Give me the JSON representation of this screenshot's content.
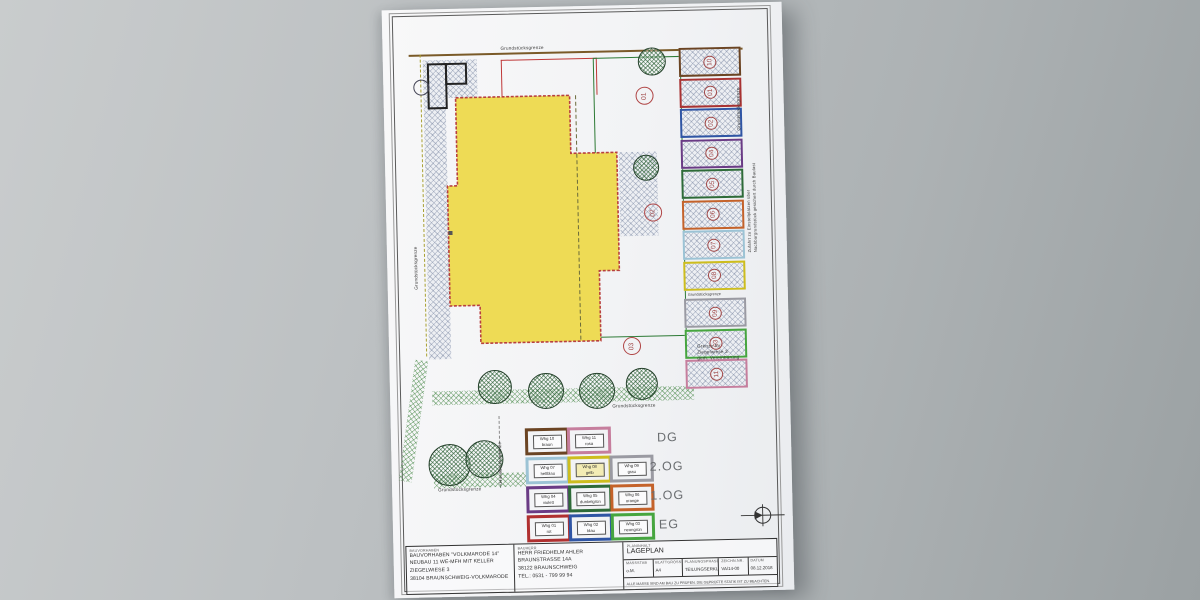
{
  "paper": {
    "labels": {
      "grundstuecksgrenze": "Grundstücksgrenze",
      "zufahrt_line1": "Zufahrt zu Einstellplätzen über",
      "zufahrt_line2": "Nachbargrundstück gesichert durch Baulast",
      "grenze_line1": "Grenze für",
      "grenze_line2": "Ziegelwiese 3",
      "grenze_line3": "gem. Vereinbarung"
    },
    "area_markers": {
      "m1": "01",
      "m2": "02",
      "m3": "03"
    },
    "parking_stalls": [
      {
        "number": "10",
        "color": "#6b4423"
      },
      {
        "number": "01",
        "color": "#a83232"
      },
      {
        "number": "02",
        "color": "#2f55a4"
      },
      {
        "number": "04",
        "color": "#6a3b85"
      },
      {
        "number": "05",
        "color": "#2e6b38"
      },
      {
        "number": "06",
        "color": "#c4622a"
      },
      {
        "number": "07",
        "color": "#9cc3d5"
      },
      {
        "number": "08",
        "color": "#cdbd1e"
      },
      {
        "number": "09",
        "color": "#9a9aa2"
      },
      {
        "number": "03",
        "color": "#46a53f"
      },
      {
        "number": "11",
        "color": "#c67e9d"
      }
    ],
    "legend": {
      "rows": [
        {
          "floor": "DG",
          "items": [
            {
              "label": "Whg 10",
              "color_name": "braun",
              "color": "#6b4423"
            },
            {
              "label": "Whg 11",
              "color_name": "rosa",
              "color": "#c67e9d"
            }
          ]
        },
        {
          "floor": "2.OG",
          "items": [
            {
              "label": "Whg 07",
              "color_name": "hellblau",
              "color": "#9cc3d5"
            },
            {
              "label": "Whg 08",
              "color_name": "gelb",
              "color": "#cdbd1e"
            },
            {
              "label": "Whg 09",
              "color_name": "grau",
              "color": "#9a9aa2"
            }
          ]
        },
        {
          "floor": "1.OG",
          "items": [
            {
              "label": "Whg 04",
              "color_name": "violett",
              "color": "#6a3b85"
            },
            {
              "label": "Whg 05",
              "color_name": "dunkelgrün",
              "color": "#2e6b38"
            },
            {
              "label": "Whg 06",
              "color_name": "orange",
              "color": "#c4622a"
            }
          ]
        },
        {
          "floor": "EG",
          "items": [
            {
              "label": "Whg 01",
              "color_name": "rot",
              "color": "#b03030"
            },
            {
              "label": "Whg 02",
              "color_name": "blau",
              "color": "#2f55a4"
            },
            {
              "label": "Whg 03",
              "color_name": "neongrün",
              "color": "#46a53f"
            }
          ]
        }
      ]
    },
    "titleblock": {
      "col1_header": "BAUVORHABEN",
      "col1_lines": [
        "BAUVORHABEN \"VOLKMARODE 14\"",
        "NEUBAU 11 WE-MFH MIT KELLER",
        "ZIEGELWIESE 3",
        "38104 BRAUNSCHWEIG-VOLKMARODE"
      ],
      "col2_header": "BAUHERR",
      "col2_lines": [
        "HERR FRIEDHELM AHLER",
        "BRAUNSTRASSE 14A",
        "38122 BRAUNSCHWEIG",
        "TEL.: 0531  -  799 99 94"
      ],
      "col3_header": "PLANINHALT",
      "plan_title": "LAGEPLAN",
      "fields": [
        {
          "header": "MASSSTAB",
          "value": "o.M."
        },
        {
          "header": "BLATTGRÖSSE",
          "value": "A4"
        },
        {
          "header": "PLANUNGSPHASE",
          "value": "TEILUNGSERKL."
        },
        {
          "header": "ZEICHN.NR.",
          "value": "VA/14-00"
        },
        {
          "header": "DATUM",
          "value": "08.12.2018"
        }
      ],
      "note": "ALLE MASSE SIND AM BAU ZU PRÜFEN. DIE GEPRÜFTE STATIK IST ZU BEACHTEN."
    }
  }
}
